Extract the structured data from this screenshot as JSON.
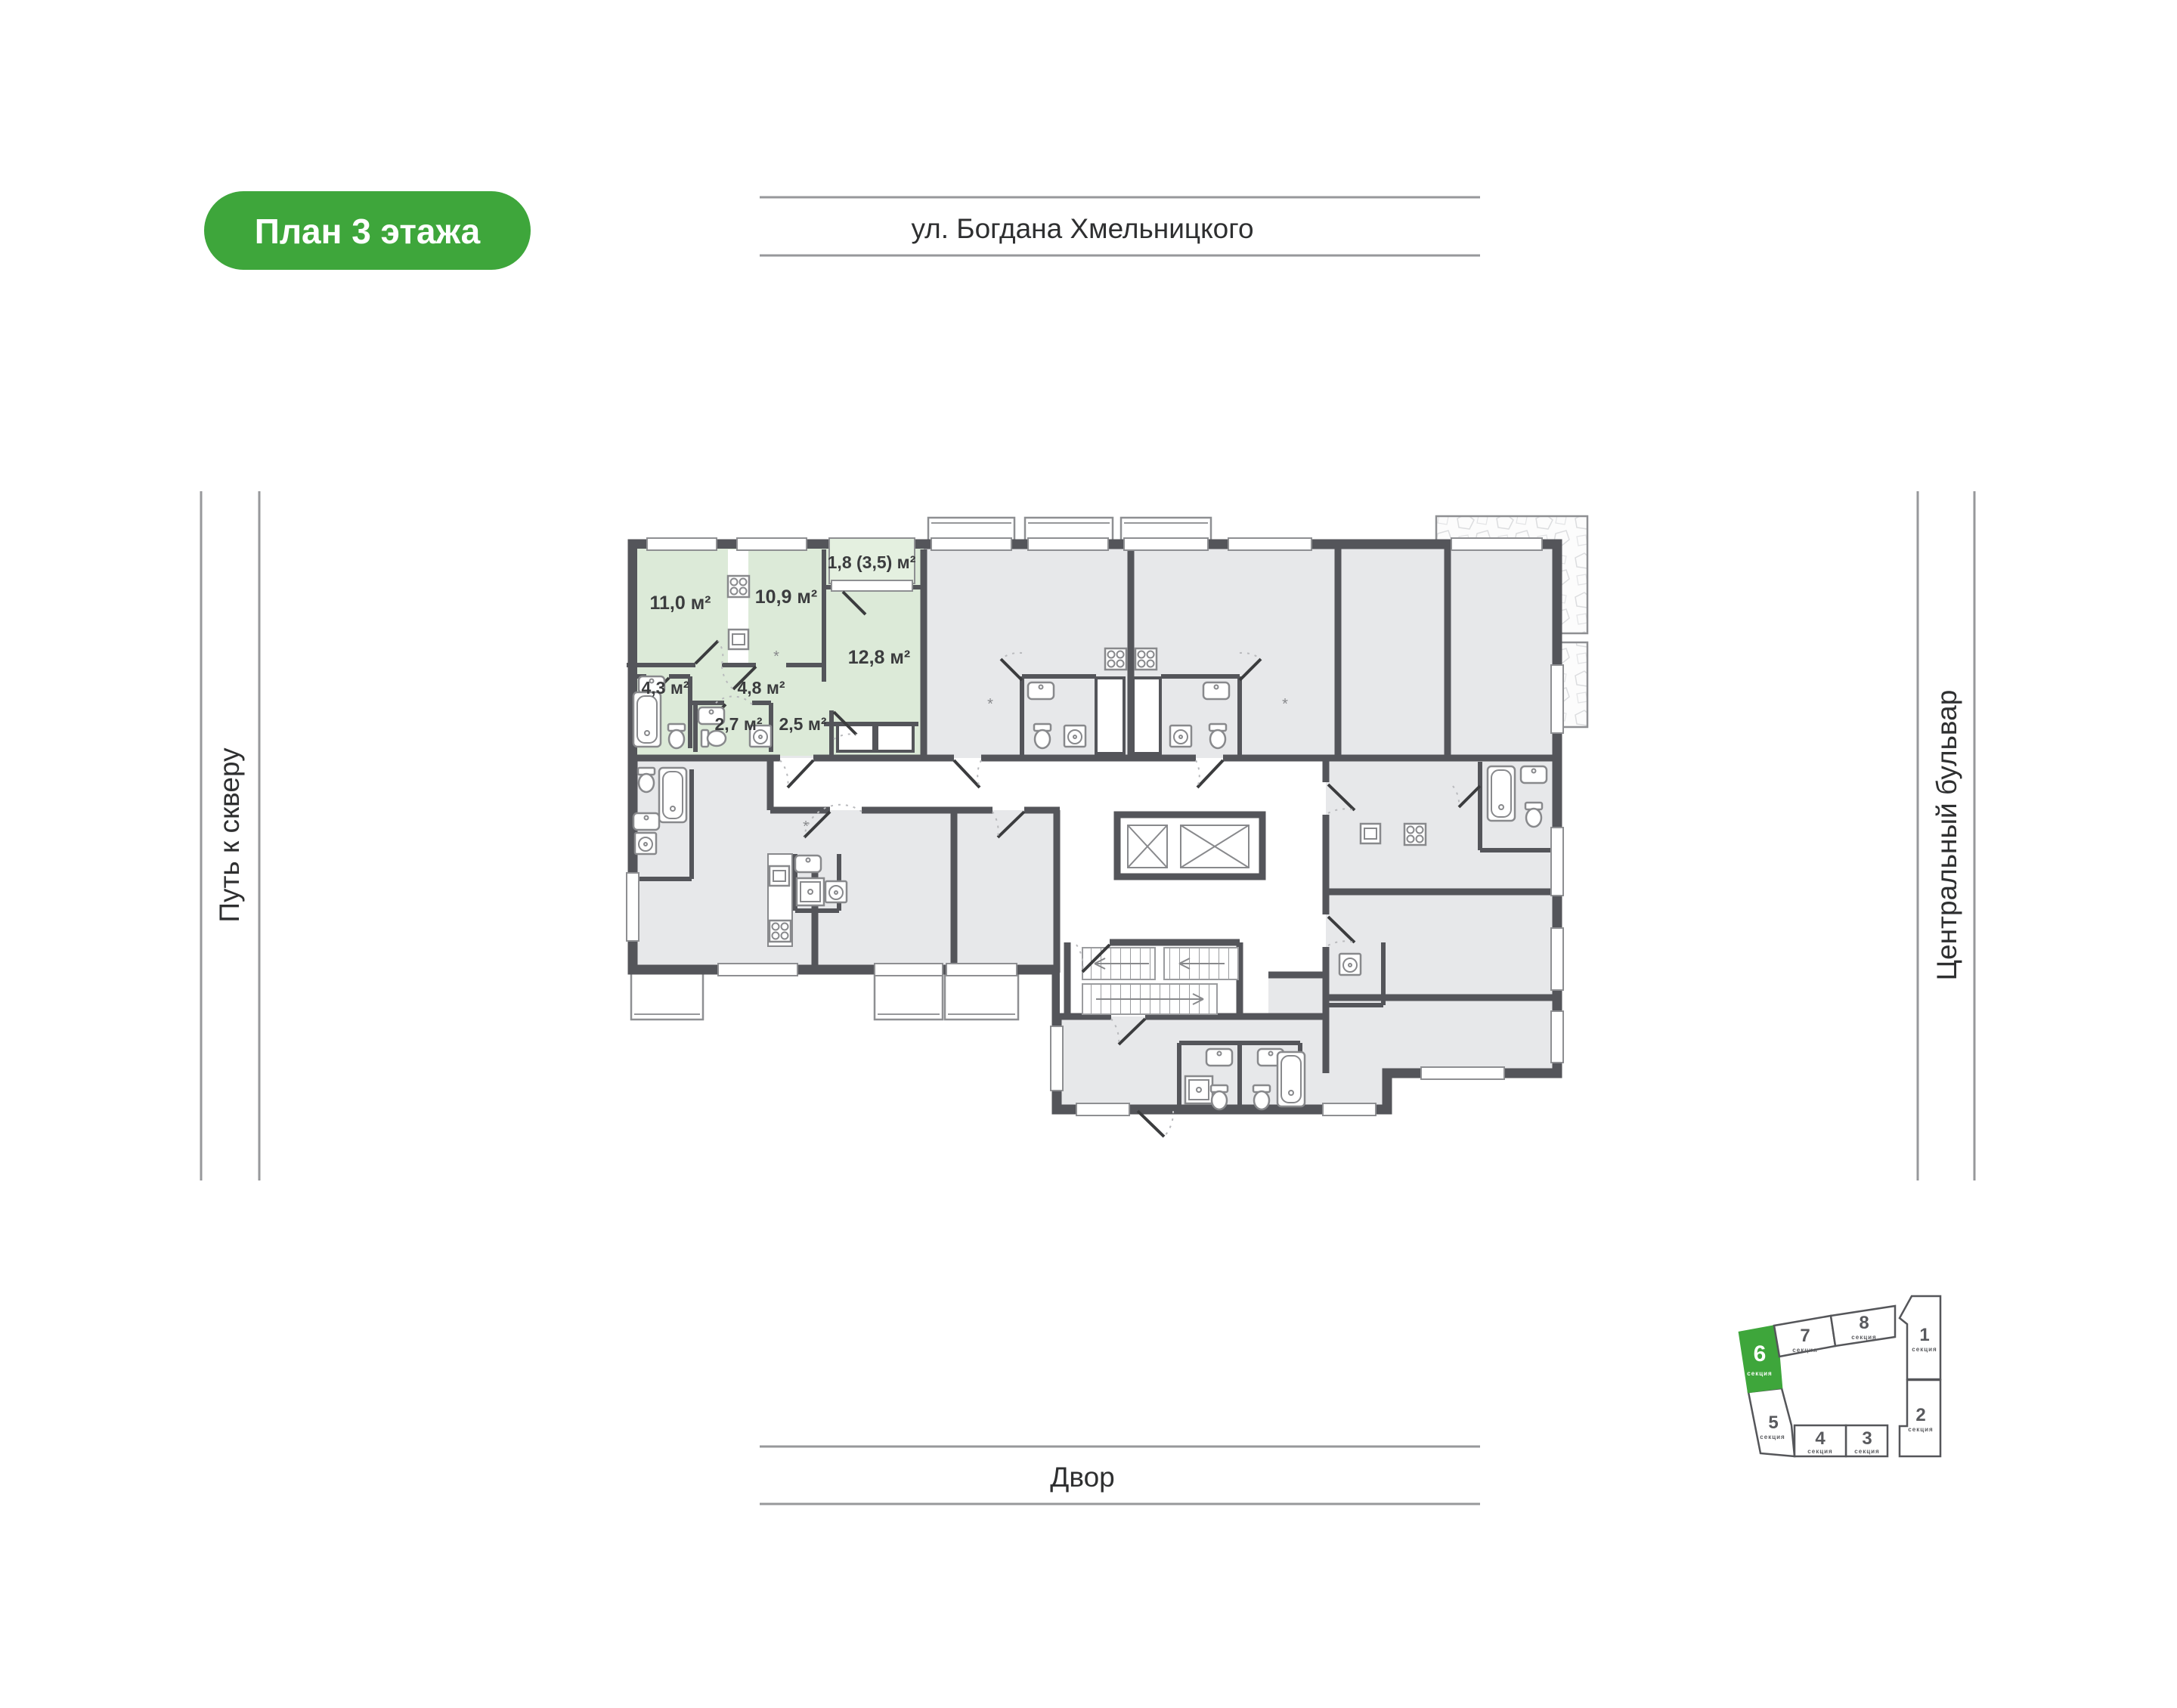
{
  "badge": {
    "label": "План 3 этажа"
  },
  "surroundings": {
    "top": "ул. Богдана Хмельницкого",
    "bottom": "Двор",
    "left": "Путь к скверу",
    "right": "Центральный бульвар"
  },
  "apartment": {
    "highlighted": true,
    "rooms": [
      {
        "name": "living-room-1",
        "area": "11,0 м²"
      },
      {
        "name": "kitchen",
        "area": "10,9 м²"
      },
      {
        "name": "balcony",
        "area": "1,8 (3,5) м²"
      },
      {
        "name": "living-room-2",
        "area": "12,8 м²"
      },
      {
        "name": "bathroom",
        "area": "4,3 м²"
      },
      {
        "name": "hallway",
        "area": "4,8 м²"
      },
      {
        "name": "wc",
        "area": "2,7 м²"
      },
      {
        "name": "hall",
        "area": "2,5 м²"
      }
    ]
  },
  "section_map": {
    "sections": [
      {
        "number": "1",
        "label": "секция",
        "highlighted": false
      },
      {
        "number": "2",
        "label": "секция",
        "highlighted": false
      },
      {
        "number": "3",
        "label": "секция",
        "highlighted": false
      },
      {
        "number": "4",
        "label": "секция",
        "highlighted": false
      },
      {
        "number": "5",
        "label": "секция",
        "highlighted": false
      },
      {
        "number": "6",
        "label": "секция",
        "highlighted": true
      },
      {
        "number": "7",
        "label": "секция",
        "highlighted": false
      },
      {
        "number": "8",
        "label": "секция",
        "highlighted": false
      }
    ]
  },
  "colors": {
    "accent_green": "#3EA63B",
    "highlight_fill": "#DCEAD8",
    "balcony_fill": "#E4F0E0",
    "wall": "#54555A",
    "room_fill": "#E7E8EA"
  }
}
